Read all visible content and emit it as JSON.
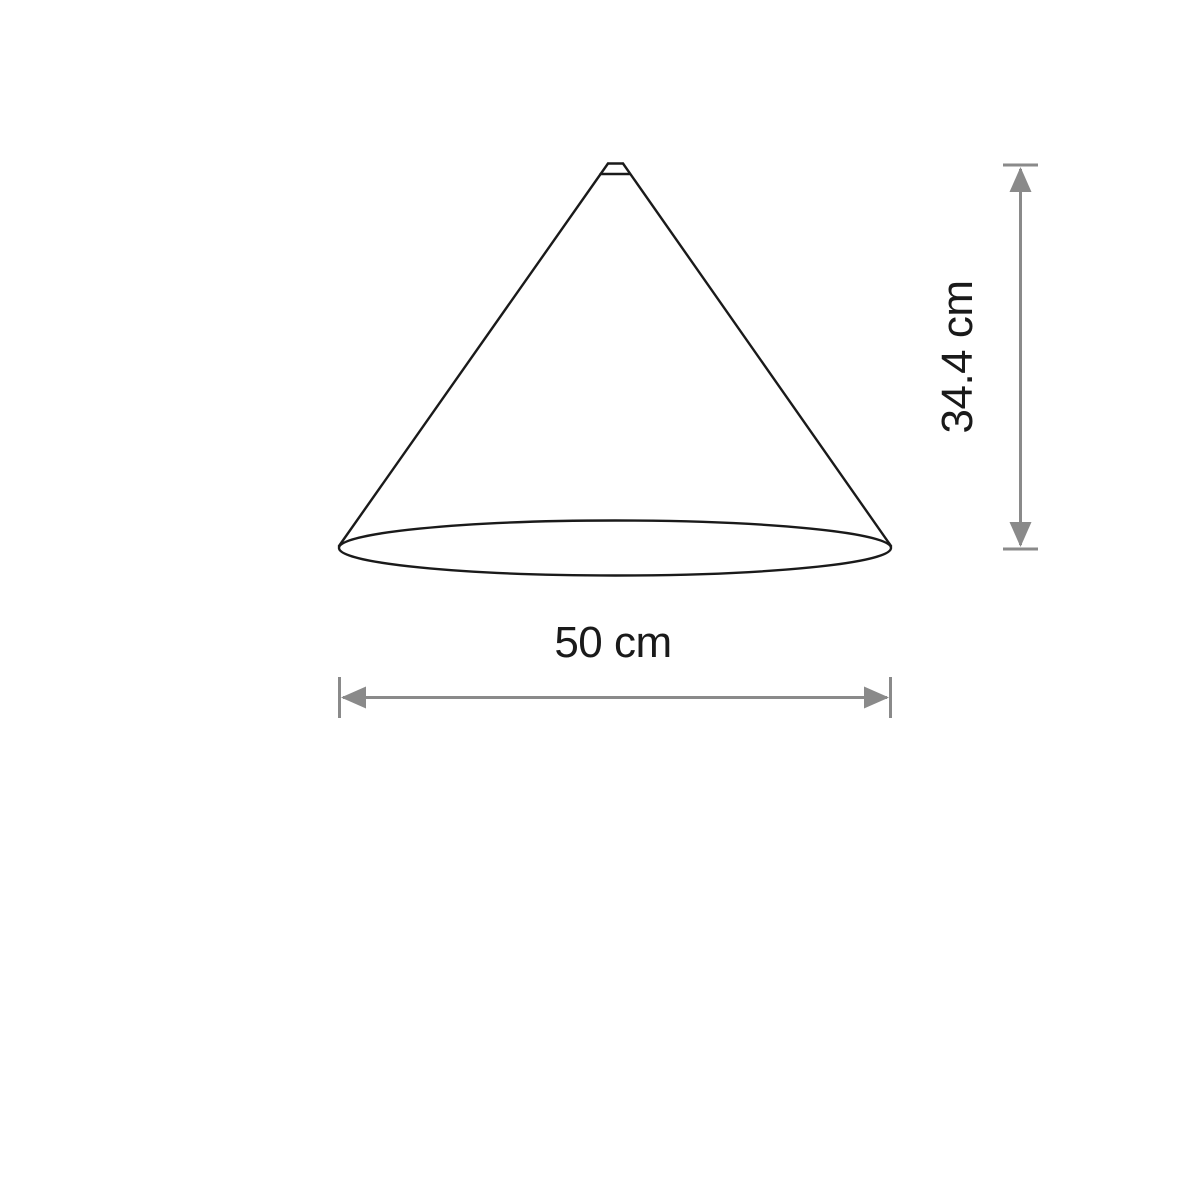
{
  "diagram": {
    "subject": "cone-shade-dimension-drawing",
    "width_label": "50 cm",
    "height_label": "34.4 cm"
  },
  "colors": {
    "outline": "#1a1a1a",
    "dimension": "#8a8a8a",
    "text": "#1a1a1a",
    "background": "#ffffff"
  }
}
